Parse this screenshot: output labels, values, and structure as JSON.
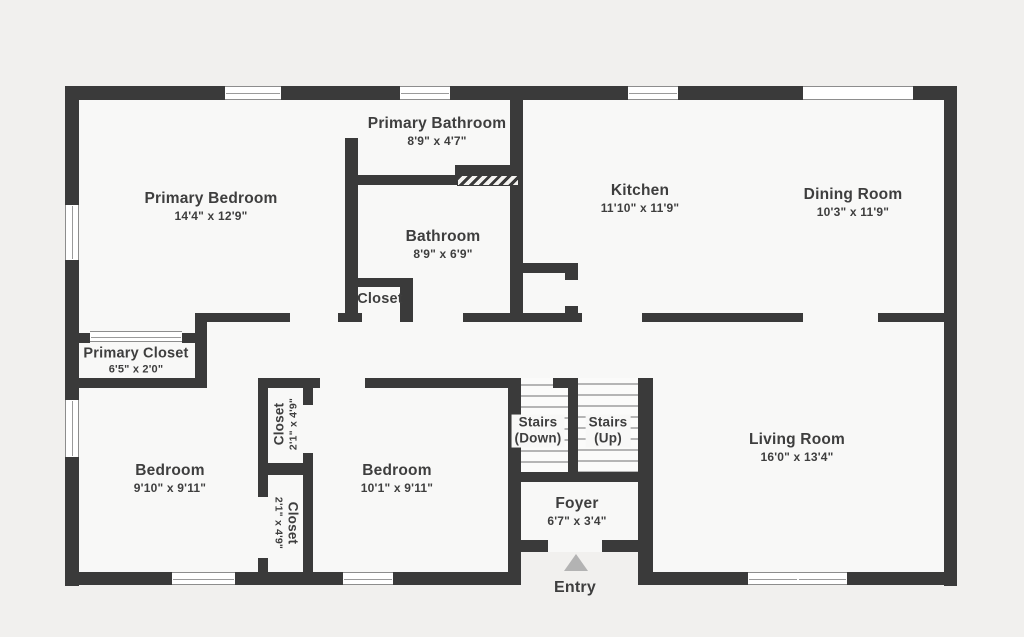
{
  "plan": {
    "canvas": {
      "width": 1024,
      "height": 637
    },
    "colors": {
      "outside": "#f1f0ee",
      "floor": "#f8f8f7",
      "wall": "#3a3a3a",
      "tread": "#b5b5b5",
      "text": "#3e3e3e",
      "entry_arrow": "#b3b3b3",
      "window_frame": "#8d8d8d"
    }
  },
  "labels": [
    {
      "id": "primary-bathroom-label",
      "x": 437,
      "y": 132,
      "lines": [
        {
          "t": "Primary Bathroom",
          "s": 15.5
        },
        {
          "t": "8'9\" x 4'7\"",
          "s": 12
        }
      ]
    },
    {
      "id": "primary-bedroom-label",
      "x": 211,
      "y": 207,
      "lines": [
        {
          "t": "Primary Bedroom",
          "s": 15.5
        },
        {
          "t": "14'4\" x 12'9\"",
          "s": 12
        }
      ]
    },
    {
      "id": "bathroom-label",
      "x": 443,
      "y": 245,
      "lines": [
        {
          "t": "Bathroom",
          "s": 15.5
        },
        {
          "t": "8'9\" x 6'9\"",
          "s": 12
        }
      ]
    },
    {
      "id": "hall-closet-label",
      "x": 380,
      "y": 300,
      "lines": [
        {
          "t": "Closet",
          "s": 14.5
        }
      ]
    },
    {
      "id": "kitchen-label",
      "x": 640,
      "y": 199,
      "lines": [
        {
          "t": "Kitchen",
          "s": 15.5
        },
        {
          "t": "11'10\" x 11'9\"",
          "s": 12
        }
      ]
    },
    {
      "id": "dining-room-label",
      "x": 853,
      "y": 203,
      "lines": [
        {
          "t": "Dining Room",
          "s": 15.5
        },
        {
          "t": "10'3\" x 11'9\"",
          "s": 12
        }
      ]
    },
    {
      "id": "primary-closet-label",
      "x": 136,
      "y": 361,
      "lines": [
        {
          "t": "Primary Closet",
          "s": 14.5
        },
        {
          "t": "6'5\" x 2'0\"",
          "s": 11
        }
      ]
    },
    {
      "id": "bedroom-left-label",
      "x": 170,
      "y": 479,
      "lines": [
        {
          "t": "Bedroom",
          "s": 15.5
        },
        {
          "t": "9'10\" x 9'11\"",
          "s": 12
        }
      ]
    },
    {
      "id": "bedroom-right-label",
      "x": 397,
      "y": 479,
      "lines": [
        {
          "t": "Bedroom",
          "s": 15.5
        },
        {
          "t": "10'1\" x 9'11\"",
          "s": 12
        }
      ]
    },
    {
      "id": "stairs-down-label",
      "x": 538,
      "y": 431,
      "bg": true,
      "lines": [
        {
          "t": "Stairs",
          "s": 13.5
        },
        {
          "t": "(Down)",
          "s": 13.5
        }
      ]
    },
    {
      "id": "stairs-up-label",
      "x": 608,
      "y": 431,
      "bg": true,
      "lines": [
        {
          "t": "Stairs",
          "s": 13.5
        },
        {
          "t": "(Up)",
          "s": 13.5
        }
      ]
    },
    {
      "id": "living-room-label",
      "x": 797,
      "y": 448,
      "lines": [
        {
          "t": "Living Room",
          "s": 15.5
        },
        {
          "t": "16'0\" x 13'4\"",
          "s": 12
        }
      ]
    },
    {
      "id": "foyer-label",
      "x": 577,
      "y": 512,
      "lines": [
        {
          "t": "Foyer",
          "s": 15.5
        },
        {
          "t": "6'7\" x 3'4\"",
          "s": 12
        }
      ]
    },
    {
      "id": "entry-label",
      "x": 575,
      "y": 588,
      "lines": [
        {
          "t": "Entry",
          "s": 16
        }
      ]
    },
    {
      "id": "closet-top-label",
      "x": 286,
      "y": 424,
      "rot": -90,
      "lines": [
        {
          "t": "Closet",
          "s": 13.5
        },
        {
          "t": "2'1\" x 4'9\"",
          "s": 10.5
        }
      ]
    },
    {
      "id": "closet-bottom-label",
      "x": 286,
      "y": 523,
      "rot": 90,
      "lines": [
        {
          "t": "Closet",
          "s": 13.5
        },
        {
          "t": "2'1\" x 4'9\"",
          "s": 10.5
        }
      ]
    }
  ],
  "geometry": {
    "floors": [
      [
        72,
        93,
        878,
        486
      ]
    ],
    "notches": [
      [
        521,
        552,
        117,
        50
      ]
    ],
    "stairwells": [
      [
        521,
        378,
        47,
        94
      ],
      [
        578,
        378,
        60,
        104
      ]
    ],
    "treads": [
      [
        521,
        384,
        47
      ],
      [
        521,
        395,
        47
      ],
      [
        521,
        406,
        47
      ],
      [
        521,
        417,
        47
      ],
      [
        521,
        428,
        47
      ],
      [
        521,
        439,
        47
      ],
      [
        521,
        450,
        47
      ],
      [
        521,
        461,
        47
      ],
      [
        578,
        383,
        60
      ],
      [
        578,
        394,
        60
      ],
      [
        578,
        405,
        60
      ],
      [
        578,
        416,
        60
      ],
      [
        578,
        427,
        60
      ],
      [
        578,
        438,
        60
      ],
      [
        578,
        449,
        60
      ],
      [
        578,
        460,
        60
      ],
      [
        578,
        471,
        60
      ]
    ],
    "walls": [
      [
        65,
        86,
        892,
        14
      ],
      [
        65,
        86,
        14,
        500
      ],
      [
        944,
        86,
        13,
        500
      ],
      [
        65,
        572,
        456,
        13
      ],
      [
        638,
        572,
        319,
        13
      ],
      [
        345,
        100,
        13,
        222
      ],
      [
        345,
        175,
        112,
        10
      ],
      [
        455,
        165,
        64,
        10
      ],
      [
        510,
        100,
        13,
        213
      ],
      [
        516,
        263,
        62,
        10
      ],
      [
        565,
        263,
        13,
        59
      ],
      [
        197,
        313,
        93,
        9
      ],
      [
        338,
        313,
        24,
        9
      ],
      [
        400,
        313,
        13,
        9
      ],
      [
        463,
        313,
        119,
        9
      ],
      [
        642,
        313,
        161,
        9
      ],
      [
        878,
        313,
        79,
        9
      ],
      [
        345,
        278,
        68,
        9
      ],
      [
        400,
        278,
        13,
        44
      ],
      [
        195,
        313,
        12,
        75
      ],
      [
        65,
        333,
        25,
        10
      ],
      [
        182,
        333,
        25,
        10
      ],
      [
        65,
        378,
        142,
        10
      ],
      [
        262,
        378,
        58,
        10
      ],
      [
        365,
        378,
        156,
        10
      ],
      [
        553,
        378,
        15,
        10
      ],
      [
        508,
        378,
        13,
        207
      ],
      [
        258,
        378,
        10,
        90
      ],
      [
        303,
        387,
        10,
        18
      ],
      [
        303,
        453,
        10,
        22
      ],
      [
        258,
        463,
        55,
        12
      ],
      [
        258,
        475,
        10,
        22
      ],
      [
        258,
        558,
        10,
        17
      ],
      [
        303,
        475,
        10,
        100
      ],
      [
        568,
        378,
        10,
        104
      ],
      [
        638,
        378,
        15,
        207
      ],
      [
        508,
        472,
        145,
        10
      ],
      [
        508,
        540,
        145,
        12
      ],
      [
        738,
        572,
        10,
        13
      ],
      [
        847,
        572,
        10,
        13
      ]
    ],
    "gaps": [
      [
        345,
        100,
        13,
        38
      ],
      [
        565,
        280,
        13,
        26
      ],
      [
        548,
        540,
        54,
        12
      ]
    ],
    "windows": [
      {
        "r": [
          225,
          86,
          56,
          14
        ],
        "o": "h"
      },
      {
        "r": [
          400,
          86,
          50,
          14
        ],
        "o": "h"
      },
      {
        "r": [
          628,
          86,
          50,
          14
        ],
        "o": "h"
      },
      {
        "r": [
          803,
          86,
          110,
          14
        ],
        "o": "h",
        "plain": true
      },
      {
        "r": [
          65,
          205,
          14,
          55
        ],
        "o": "v"
      },
      {
        "r": [
          65,
          400,
          14,
          57
        ],
        "o": "v"
      },
      {
        "r": [
          172,
          572,
          63,
          13
        ],
        "o": "h"
      },
      {
        "r": [
          343,
          572,
          50,
          13
        ],
        "o": "h"
      },
      {
        "r": [
          748,
          572,
          50,
          13
        ],
        "o": "h"
      },
      {
        "r": [
          798,
          572,
          49,
          13
        ],
        "o": "h"
      },
      {
        "r": [
          90,
          331,
          92,
          11
        ],
        "o": "h"
      }
    ],
    "hatches": [
      [
        457,
        175,
        62,
        11
      ]
    ],
    "entry_arrow": [
      564,
      554
    ]
  }
}
